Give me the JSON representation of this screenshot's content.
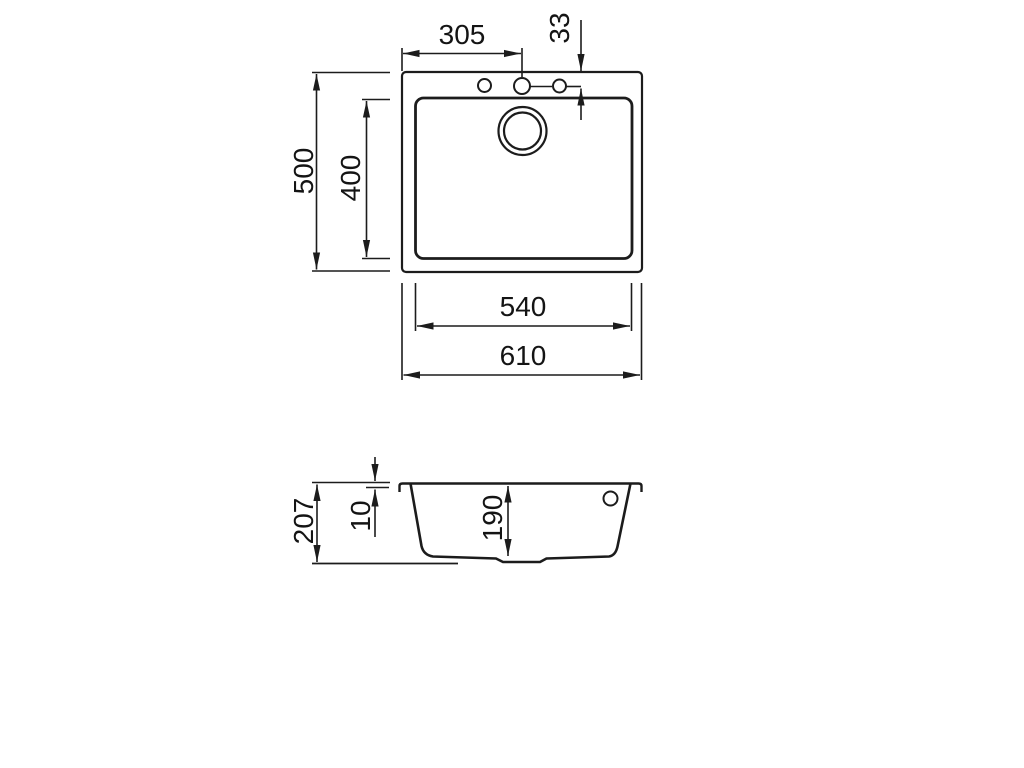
{
  "document": {
    "kind": "sink-technical-drawing",
    "colors": {
      "background": "#ffffff",
      "line": "#1c1c1c",
      "text": "#141414"
    }
  },
  "plan_view": {
    "dim_faucet_offset": "305",
    "dim_hole_inset": "33",
    "dim_overall_depth": "500",
    "dim_bowl_depth": "400",
    "dim_bowl_width": "540",
    "dim_overall_width": "610"
  },
  "section_view": {
    "dim_overall_height": "207",
    "dim_rim_thickness": "10",
    "dim_bowl_inner_depth": "190"
  }
}
